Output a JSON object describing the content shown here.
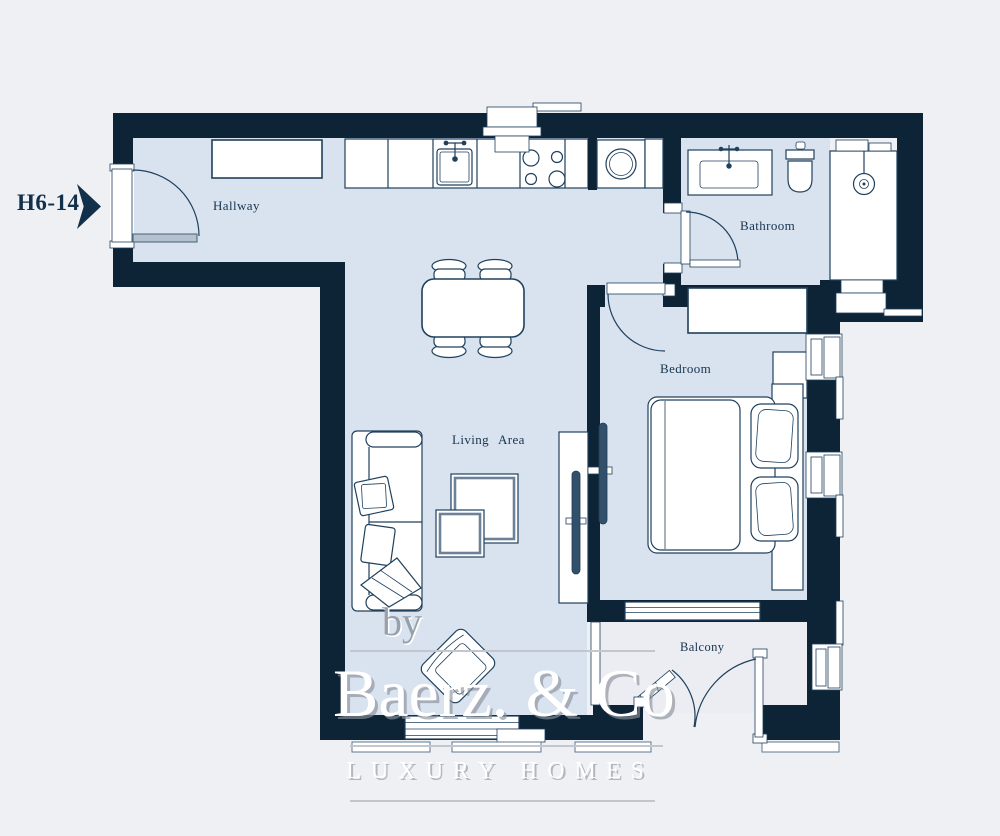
{
  "plan": {
    "unit_label": "H6-14",
    "rooms": {
      "hallway": "Hallway",
      "bathroom": "Bathroom",
      "bedroom": "Bedroom",
      "living": "Living Area",
      "balcony": "Balcony"
    },
    "watermark": {
      "by": "by",
      "brand": "Baerz. & Co",
      "tagline": "LUXURY HOMES"
    },
    "colors": {
      "wall": "#0d2436",
      "floor": "#d9e3ef",
      "balcony_floor": "#ebedf2",
      "background": "#eef0f3",
      "outline": "#20405c",
      "label": "#17344e"
    },
    "fixtures": [
      "entrance-door",
      "hallway-closet",
      "kitchen-counter",
      "kitchen-sink",
      "stove",
      "range-hood",
      "washing-machine",
      "bathroom-vanity",
      "toilet",
      "bathroom-door",
      "shower",
      "dining-table",
      "dining-chairs",
      "sofa",
      "coffee-tables",
      "armchair",
      "tv-living",
      "tv-bedroom",
      "bedroom-door",
      "wardrobe",
      "nightstand",
      "double-bed",
      "bedroom-window",
      "balcony-doors",
      "living-window",
      "ac-vents"
    ]
  }
}
